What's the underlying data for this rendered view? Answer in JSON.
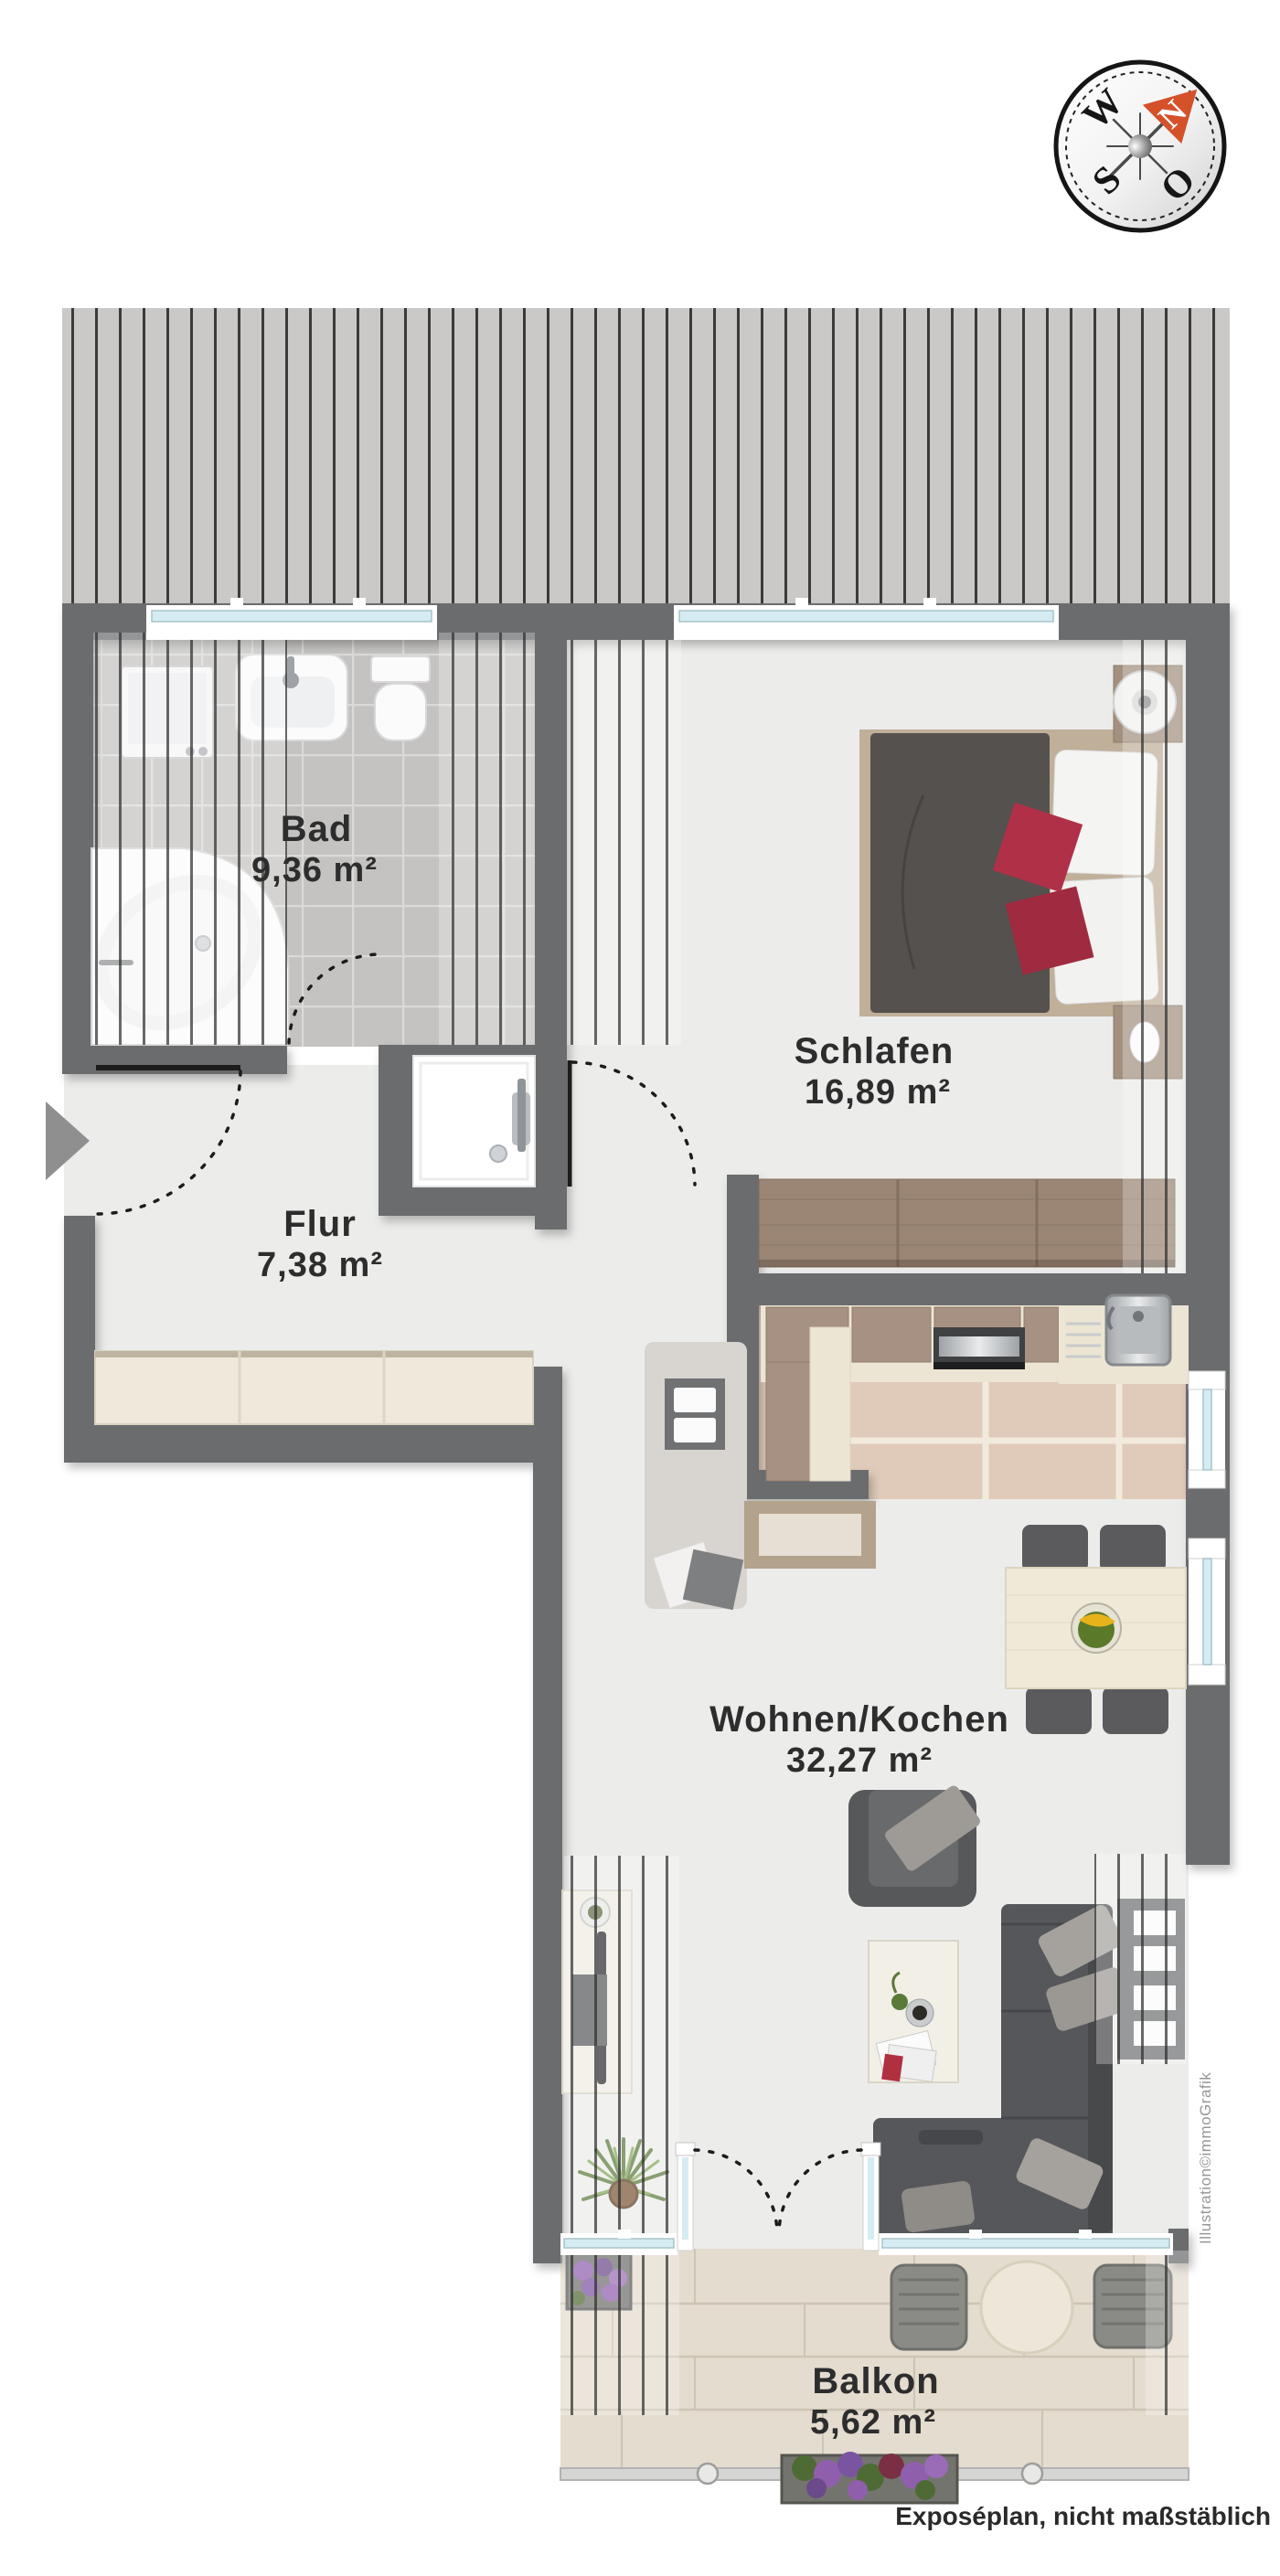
{
  "compass": {
    "west": "W",
    "north": "N",
    "east": "O",
    "south": "S"
  },
  "rooms": {
    "bad": {
      "name": "Bad",
      "area": "9,36 m²"
    },
    "flur": {
      "name": "Flur",
      "area": "7,38 m²"
    },
    "schlafen": {
      "name": "Schlafen",
      "area": "16,89 m²"
    },
    "wohnen": {
      "name": "Wohnen/Kochen",
      "area": "32,27 m²"
    },
    "balkon": {
      "name": "Balkon",
      "area": "5,62 m²"
    }
  },
  "annotations": {
    "watermark": "Illustration©immoGrafik",
    "footer_note": "Exposéplan, nicht maßstäblich"
  },
  "colors": {
    "wall": "#6a6c6e",
    "floor": "#ecedeb",
    "bath_tile": "#c4c3c1",
    "kitchen_tile": "#e0cbba",
    "balcony_floor": "#e3dccf",
    "roof": "#cac9c7",
    "wood": "#a08d7b",
    "accent_red": "#b03048",
    "compass_orange": "#d4512a",
    "glass": "#d5ecf2"
  }
}
